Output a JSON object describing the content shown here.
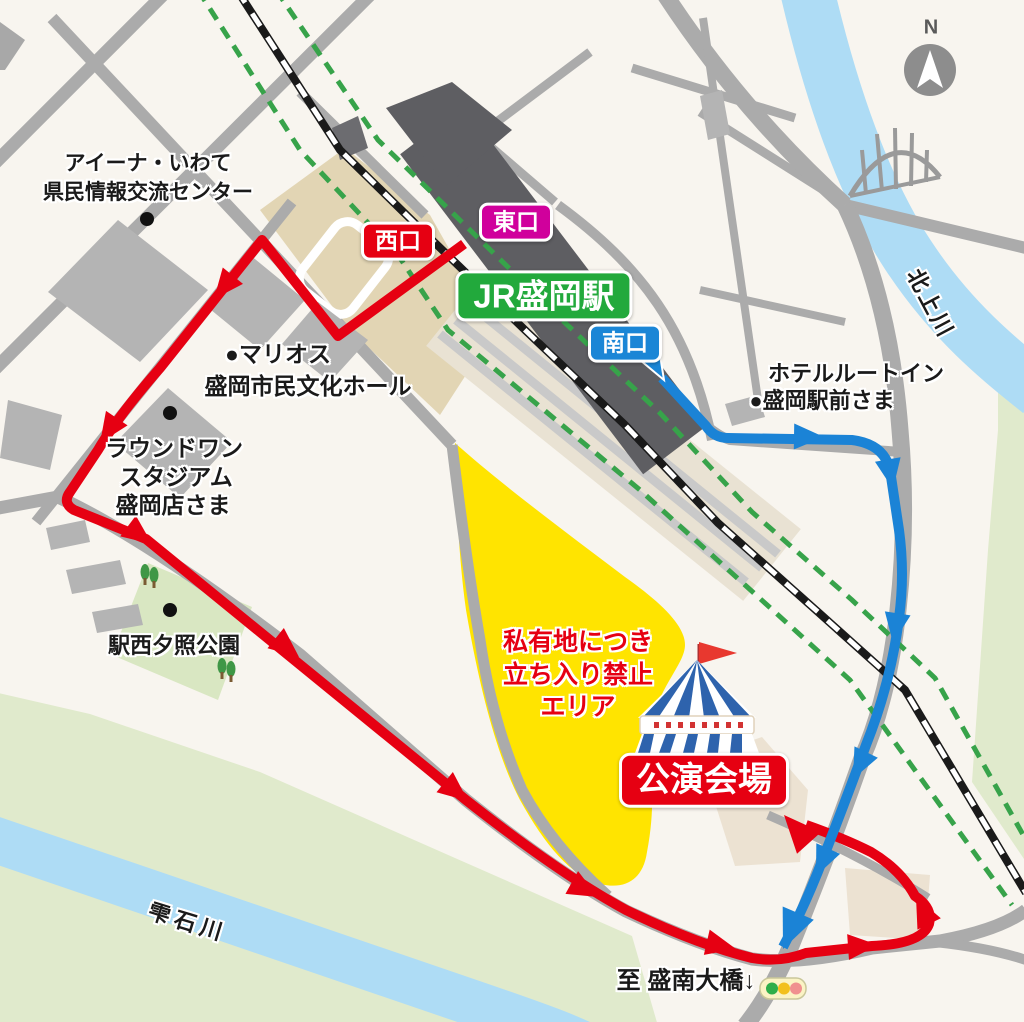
{
  "station": {
    "name": "JR盛岡駅",
    "west_exit": "西口",
    "east_exit": "東口",
    "south_exit": "南口"
  },
  "venue_label": "公演会場",
  "no_entry": {
    "line1": "私有地につき",
    "line2": "立ち入り禁止",
    "line3": "エリア"
  },
  "landmarks": {
    "aiina_line1": "アイーナ・いわて",
    "aiina_line2": "県民情報交流センター",
    "marios_line1": "●マリオス",
    "marios_line2": "盛岡市民文化ホール",
    "round1_line1": "ラウンドワン",
    "round1_line2": "スタジアム",
    "round1_line3": "盛岡店さま",
    "park": "駅西夕照公園",
    "hotel_line1": "ホテルルートイン",
    "hotel_line2": "●盛岡駅前さま"
  },
  "rivers": {
    "kitakami": "北上川",
    "shizukuishi": "雫石川"
  },
  "note_bottom": "至 盛南大橋↓",
  "compass_n": "N",
  "colors": {
    "red_route": "#e60012",
    "blue_route": "#1b83d6",
    "west_exit_bg": "#e60012",
    "east_exit_bg": "#d0009c",
    "south_exit_bg": "#1b86d6",
    "station_bg": "#22a93c",
    "venue_bg": "#e60012",
    "no_entry_area": "#ffe400",
    "railway_green": "#37a34a",
    "river_blue": "#aedcf5"
  }
}
